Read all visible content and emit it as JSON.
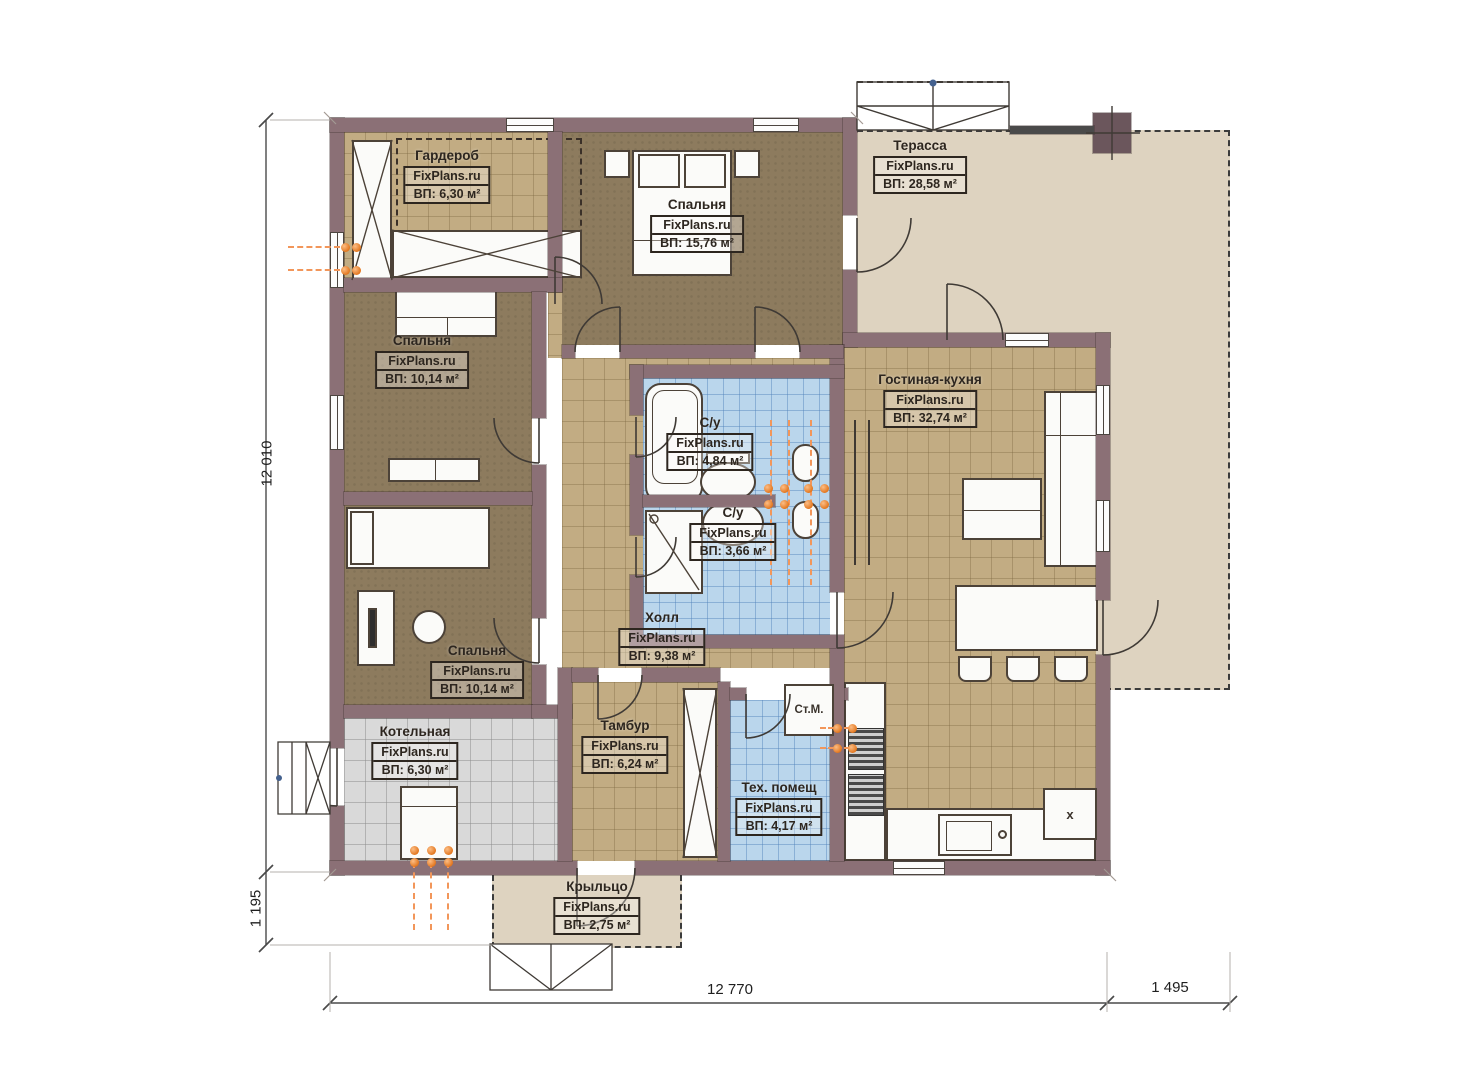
{
  "watermark": "FixPlans.ru",
  "rooms": [
    {
      "name": "Гардероб",
      "area": "ВП: 6,30 м²"
    },
    {
      "name": "Спальня",
      "area": "ВП: 15,76 м²"
    },
    {
      "name": "Терасса",
      "area": "ВП: 28,58 м²"
    },
    {
      "name": "Спальня",
      "area": "ВП: 10,14 м²"
    },
    {
      "name": "Гостиная-кухня",
      "area": "ВП: 32,74 м²"
    },
    {
      "name": "С/у",
      "area": "ВП: 4,84 м²"
    },
    {
      "name": "С/у",
      "area": "ВП: 3,66 м²"
    },
    {
      "name": "Спальня",
      "area": "ВП: 10,14 м²"
    },
    {
      "name": "Холл",
      "area": "ВП: 9,38 м²"
    },
    {
      "name": "Котельная",
      "area": "ВП: 6,30 м²"
    },
    {
      "name": "Тамбур",
      "area": "ВП: 6,24 м²"
    },
    {
      "name": "Тех. помещ",
      "area": "ВП: 4,17 м²"
    },
    {
      "name": "Крыльцо",
      "area": "ВП: 2,75 м²"
    }
  ],
  "annotations": {
    "washing_machine": "Ст.М.",
    "kitchen_mark": "x"
  },
  "dimensions": {
    "left": "12 010",
    "bottom_left": "1 195",
    "bottom_main": "12 770",
    "bottom_right": "1 495"
  },
  "colors": {
    "wall": "#8b7076",
    "floor_tan": "#c2ac83",
    "floor_brown": "#8d7b5e",
    "floor_blue": "#bad6ec",
    "floor_gray": "#d9d9d9",
    "terrace_beige": "#ded3c0",
    "radiator_orange": "#e2751c"
  }
}
